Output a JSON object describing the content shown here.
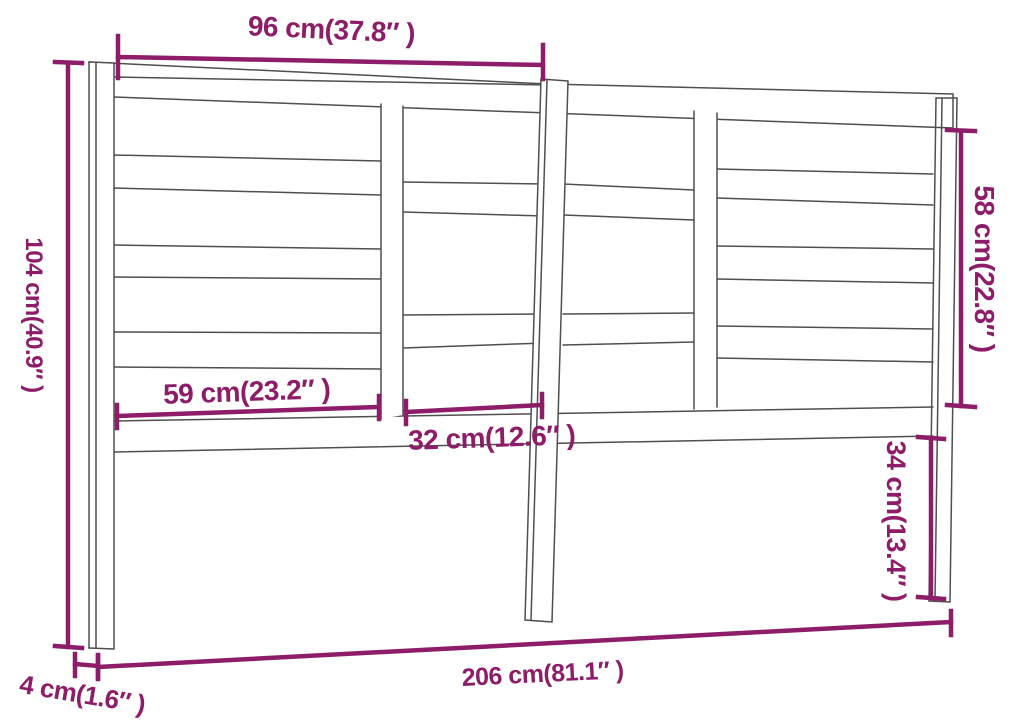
{
  "diagram": {
    "subject": "headboard-dimension-diagram",
    "dimensions": {
      "top_width": "96 cm(37.8″ )",
      "left_height": "104 cm(40.9″ )",
      "right_upper_height": "58 cm(22.8″ )",
      "right_lower_height": "34 cm(13.4″ )",
      "left_slat_width": "59 cm(23.2″ )",
      "center_slat_width": "32 cm(12.6″ )",
      "total_width": "206 cm(81.1″ )",
      "leg_thickness": "4 cm(1.6″ )"
    },
    "colors": {
      "dimension_accent": "#8d1d68",
      "drawing_line": "#4f4f4f",
      "background": "#ffffff"
    }
  }
}
